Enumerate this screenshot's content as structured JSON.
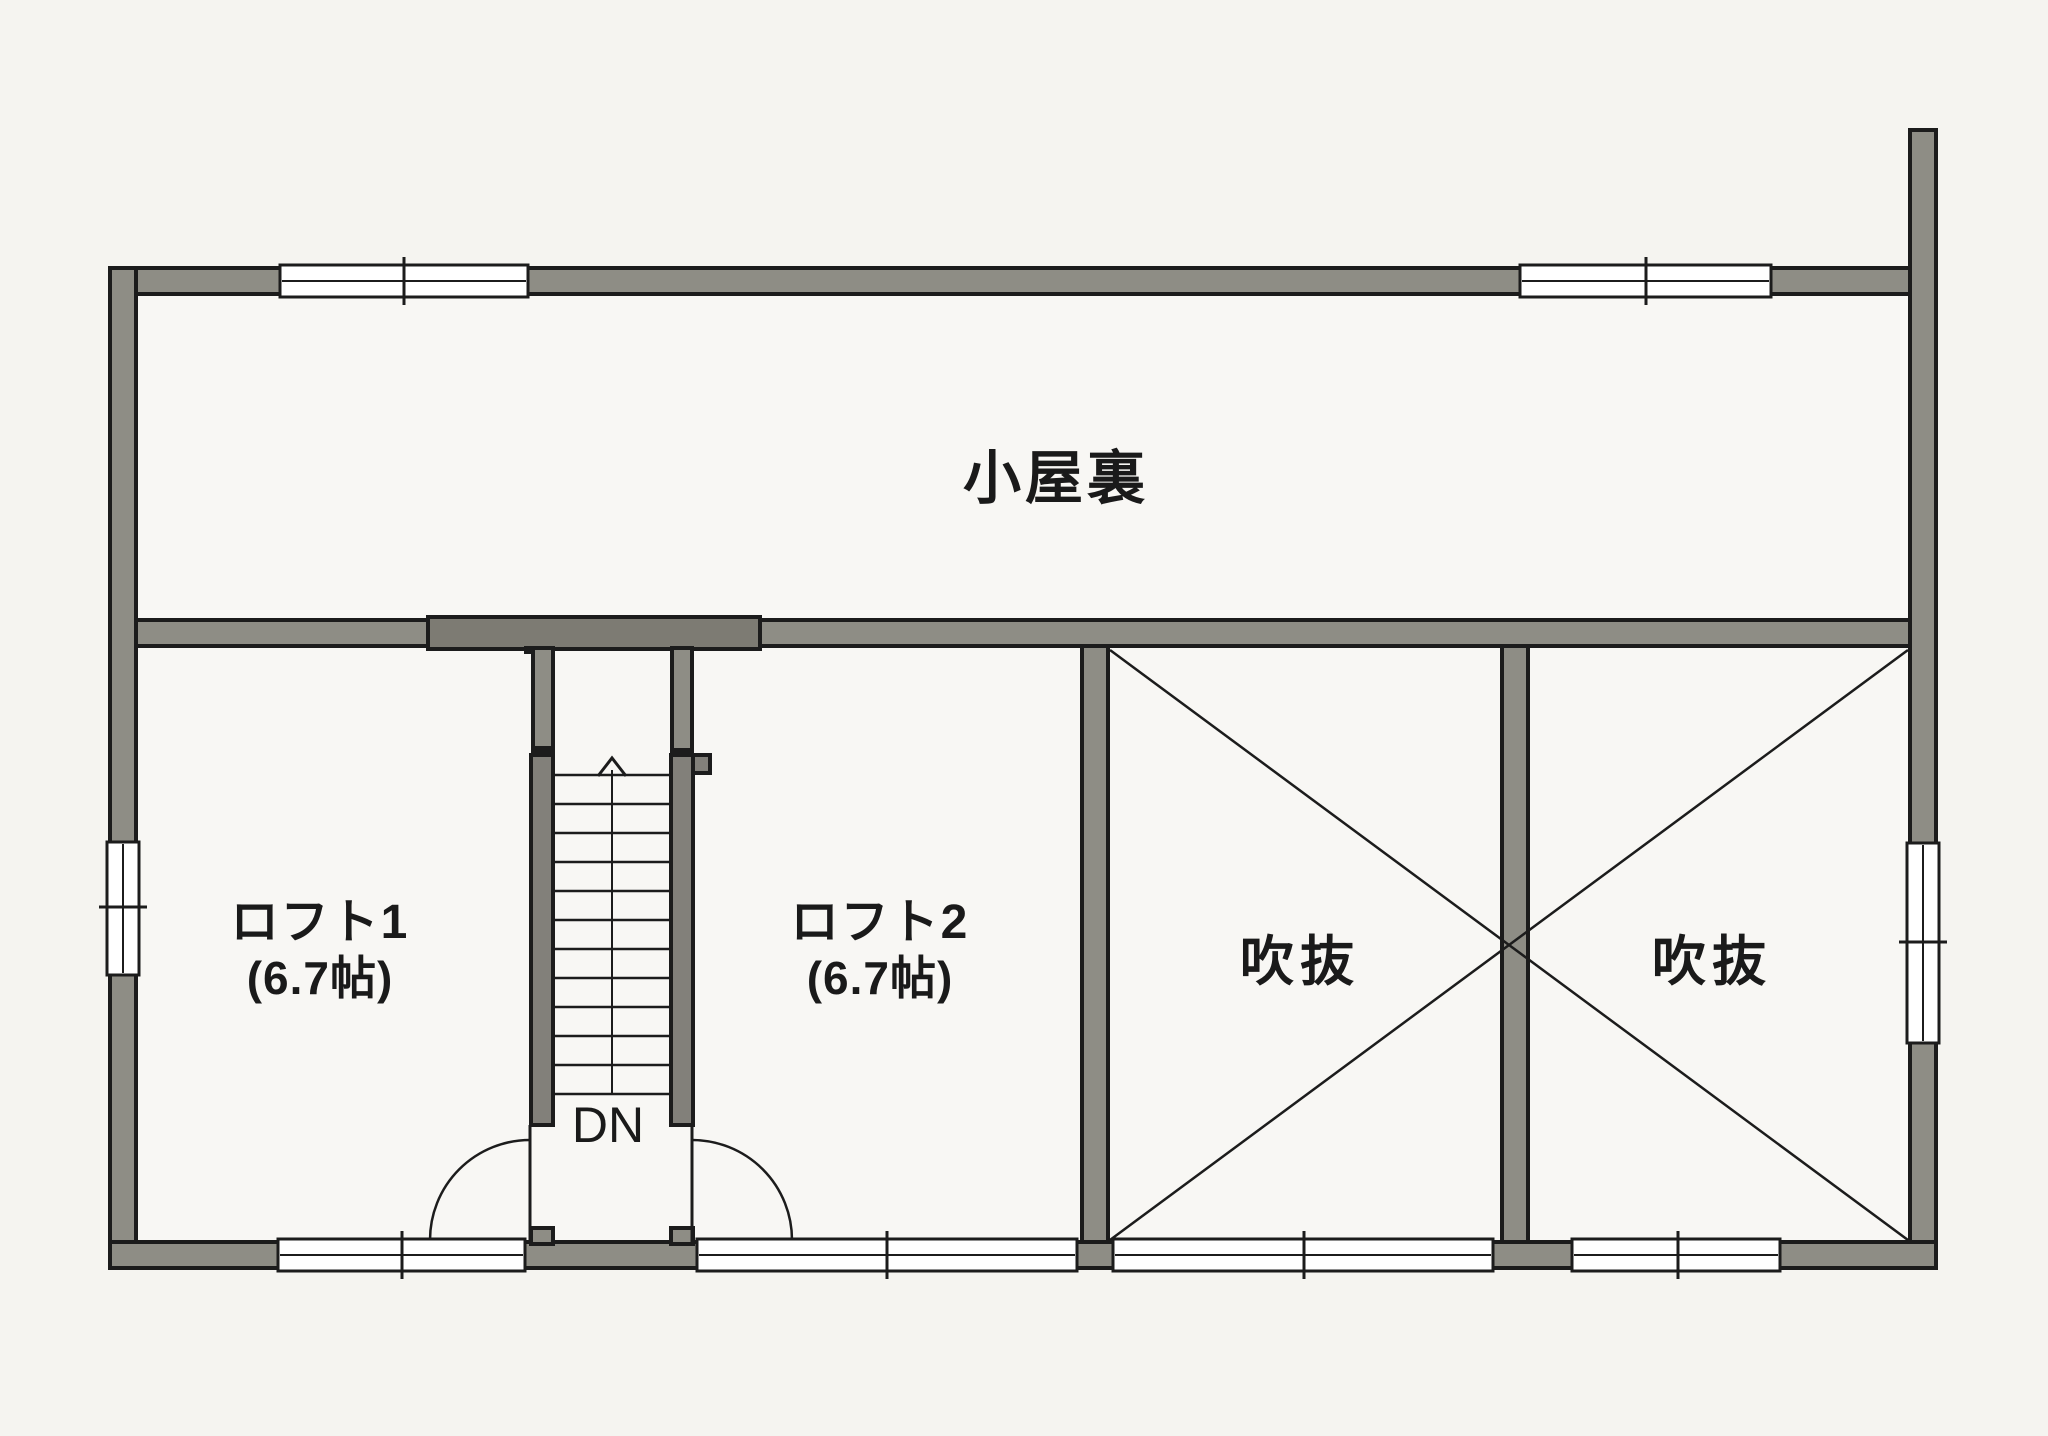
{
  "plan": {
    "title": "loft-floor-plan",
    "rooms": {
      "attic": {
        "label": "小屋裏"
      },
      "loft1": {
        "label": "ロフト1",
        "size": "(6.7帖)"
      },
      "loft2": {
        "label": "ロフト2",
        "size": "(6.7帖)"
      },
      "void1": {
        "label": "吹抜"
      },
      "void2": {
        "label": "吹抜"
      }
    },
    "stairs": {
      "label": "DN"
    },
    "colors": {
      "paper": "#f5f4f0",
      "floor": "#f8f7f4",
      "wall": "#8e8d85",
      "wall_dark": "#82807a",
      "bar": "#7d7b73",
      "line": "#1c1c1c",
      "window": "#ffffff",
      "text": "#1a1a1a"
    }
  }
}
